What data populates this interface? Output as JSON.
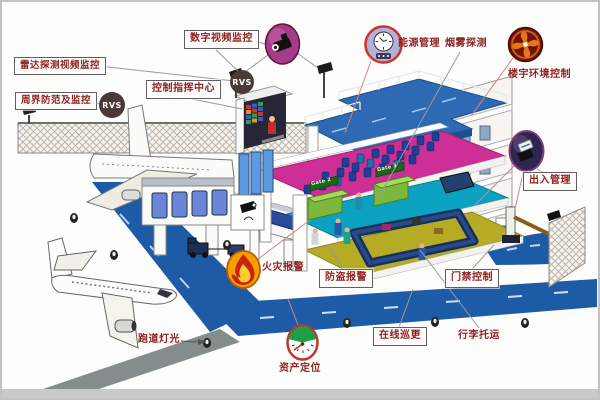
{
  "labels": {
    "radar_video": "雷达探测视频监控",
    "perimeter": "周界防范及监控",
    "digital_video": "数字视频监控",
    "control_center": "控制指挥中心",
    "energy_mgmt": "能源管理",
    "smoke_detect": "烟雾探测",
    "building_env": "楼宇环境控制",
    "entry_exit": "出入管理",
    "fire_alarm": "火灾报警",
    "intrusion_alarm": "防盗报警",
    "door_access": "门禁控制",
    "online_patrol": "在线巡更",
    "baggage": "行李托运",
    "runway_lights": "跑道灯光",
    "asset_locating": "资产定位"
  },
  "badges": {
    "rvs": "RVS"
  },
  "gates": {
    "gate_left": "Gate 2",
    "gate_right": "Gate 3"
  },
  "icons": [
    "camera-icon",
    "energy-meter-icon",
    "fan-icon",
    "card-access-icon",
    "flame-icon",
    "asset-gauge-icon"
  ],
  "colors": {
    "label_text": "#8e2323",
    "runway_blue": "#1d5ba6",
    "deck_blue": "#2d6ab3",
    "floor_magenta": "#ce2f97",
    "floor_teal": "#0aa2c0",
    "floor_yellow": "#b5ab25",
    "gate_green": "#7cb83e",
    "icon_camera_pink": "#a83a8a",
    "icon_fire_orange": "#f59f00",
    "icon_fan_red": "#701208",
    "rvs_badge": "#4a3a36"
  }
}
